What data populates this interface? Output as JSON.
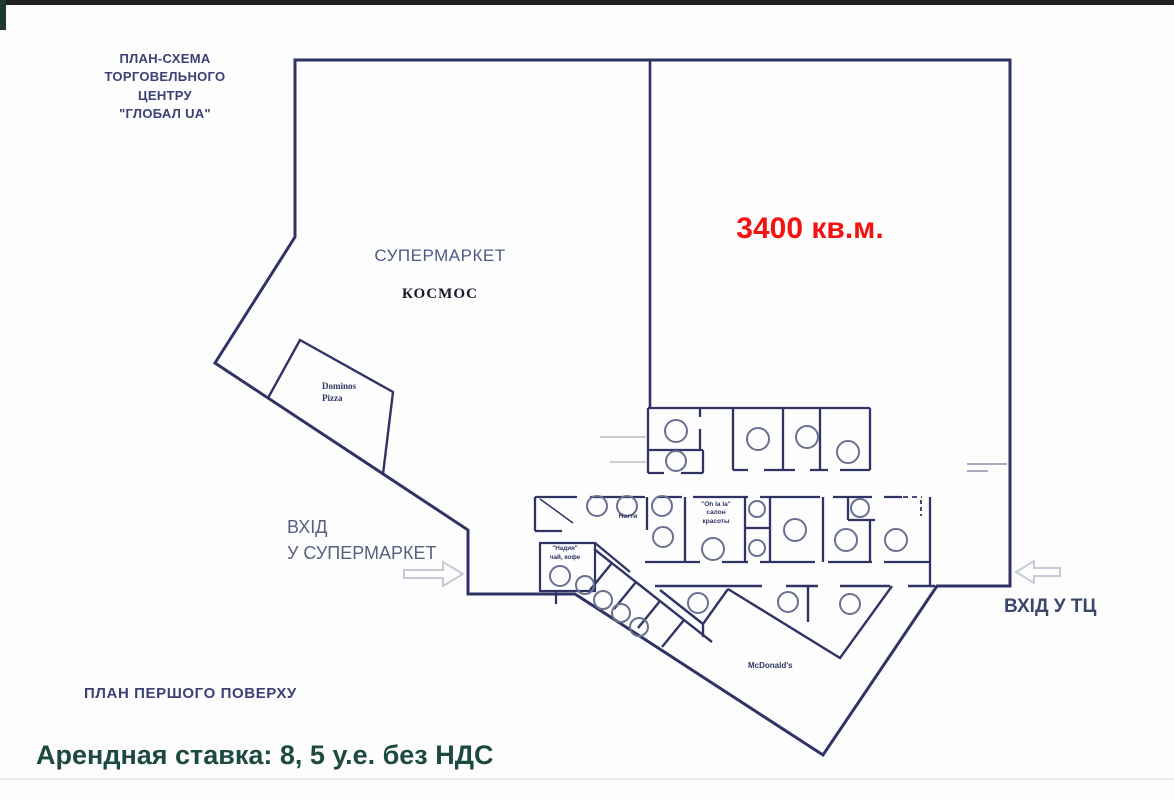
{
  "header": {
    "title": "ПЛАН-СХЕМА\nТОРГОВЕЛЬНОГО\nЦЕНТРУ\n\"ГЛОБАЛ UA\""
  },
  "supermarket": {
    "label": "СУПЕРМАРКЕТ",
    "name": "КОСМОС"
  },
  "vacant_area": {
    "size": "3400 кв.м.",
    "color": "#f31212"
  },
  "tenants": {
    "dominos": "Dominos\nPizza",
    "nails": "Ногти",
    "ohlala": "\"Oh la la\"\nсалон\nкрасоты",
    "nadia": "\"Надия\"\nчай, кофе",
    "mcdonalds": "McDonald's"
  },
  "entrances": {
    "supermarket": "ВХІД\nУ СУПЕРМАРКЕТ",
    "mall": "ВХІД У ТЦ"
  },
  "footer": {
    "plan_label": "ПЛАН ПЕРШОГО ПОВЕРХУ",
    "rate": "Арендная ставка: 8, 5 у.е. без НДС"
  },
  "colors": {
    "wall": "#2f3464",
    "door_circle": "#6a7190",
    "arrow_outline": "#c6cad5",
    "rate_text": "#1c4a41",
    "area_text": "#f31212"
  }
}
